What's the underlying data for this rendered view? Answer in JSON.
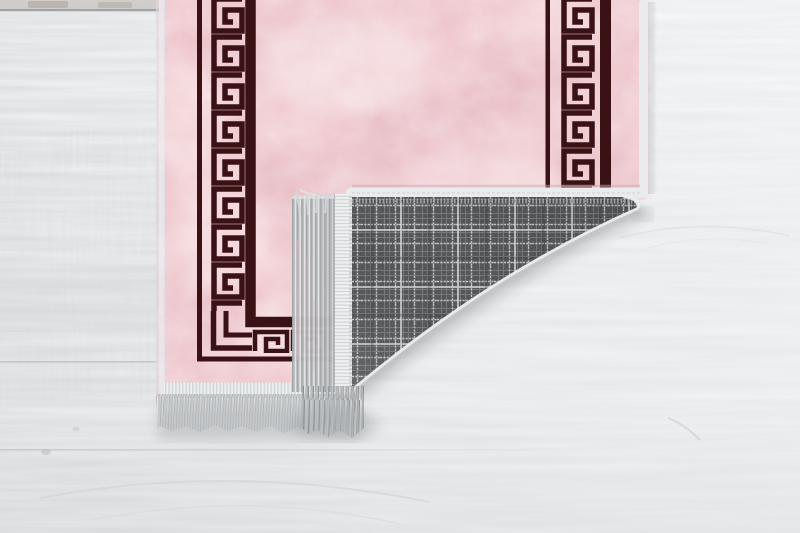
{
  "image": {
    "type": "product-photo",
    "subject": "Pink runner rug with dark Greek key meander borders, bottom-right corner folded over revealing grey plaid woven backing with silver fringe tassels, on whitewashed wooden plank floor",
    "objects": [
      "wood-floor",
      "pink-rug",
      "greek-key-border-left",
      "greek-key-border-right",
      "greek-key-border-bottom",
      "folded-corner",
      "plaid-backing",
      "fringe-tassels",
      "edge-binding"
    ]
  },
  "colors": {
    "floor_left": "#dcdee0",
    "floor_mid": "#e9ebec",
    "floor_right": "#f1f2f3",
    "plank_seam": "#94989b",
    "rug_pink_base": "#efc6cb",
    "rug_pink_light": "#fceeee",
    "rug_pink_dark": "#d89fab",
    "border_dark": "#3a1216",
    "edge_binding": "#e9ebec",
    "binding_blue": "#d9e4ee",
    "fringe_silver": "#c6c9cb",
    "fringe_shade": "#9da0a2",
    "backing_base": "#4e5052",
    "backing_line": "#9da0a2",
    "backing_line_bright": "#dadcdd",
    "shadow": "#7a7e82"
  }
}
